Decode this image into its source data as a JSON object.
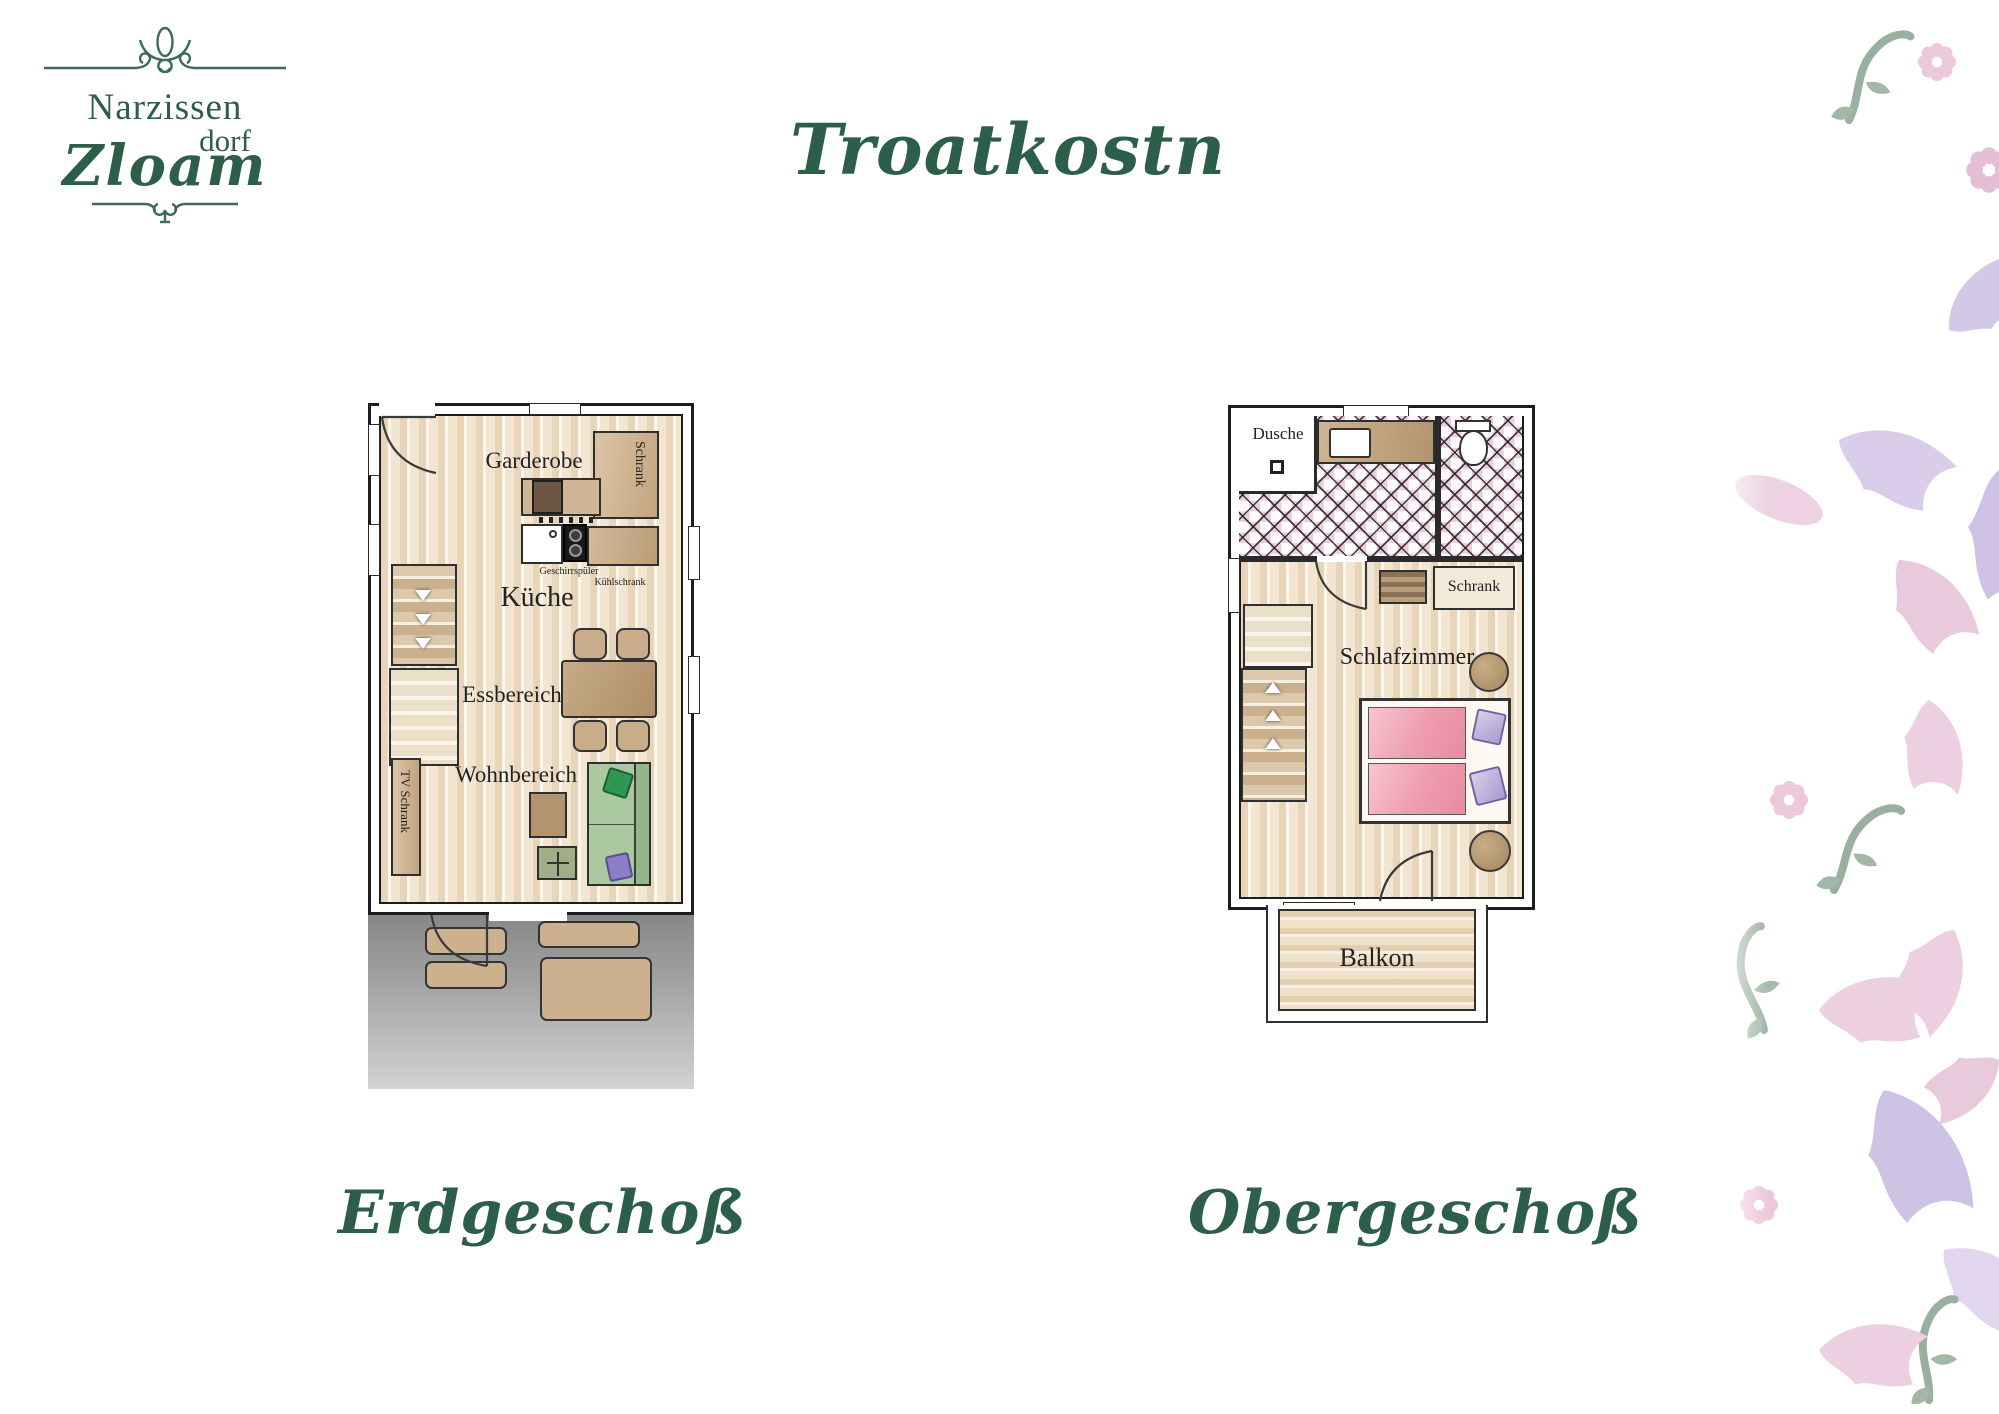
{
  "logo": {
    "line1": "Narzissen",
    "line2": "dorf",
    "line3": "Zloam"
  },
  "title": "Troatkostn",
  "ground_floor": {
    "caption": "Erdgeschoß",
    "labels": {
      "garderobe": "Garderobe",
      "schrank": "Schrank",
      "geschirrspueler": "Geschirrspüler",
      "kuehlschrank": "Kühlschrank",
      "kueche": "Küche",
      "essbereich": "Essbereich",
      "wohnbereich": "Wohnbereich",
      "tv_schrank": "TV Schrank"
    }
  },
  "upper_floor": {
    "caption": "Obergeschoß",
    "labels": {
      "dusche": "Dusche",
      "schrank": "Schrank",
      "schlafzimmer": "Schlafzimmer",
      "balkon": "Balkon"
    }
  },
  "colors": {
    "brand_green": "#2c5e4a",
    "floor_beige": "#f4e8d5",
    "furniture_brown": "#c3a783",
    "sofa_green": "#abc9a0",
    "bed_pink": "#ee9cad",
    "pillow_purple": "#b9aed6",
    "tile_pink": "#e9cedf",
    "terrace_gray": "#8c8c8c",
    "pattern_pink": "#eccfe0",
    "pattern_lavender": "#d5c9e9",
    "pattern_green": "#93ac9b"
  }
}
